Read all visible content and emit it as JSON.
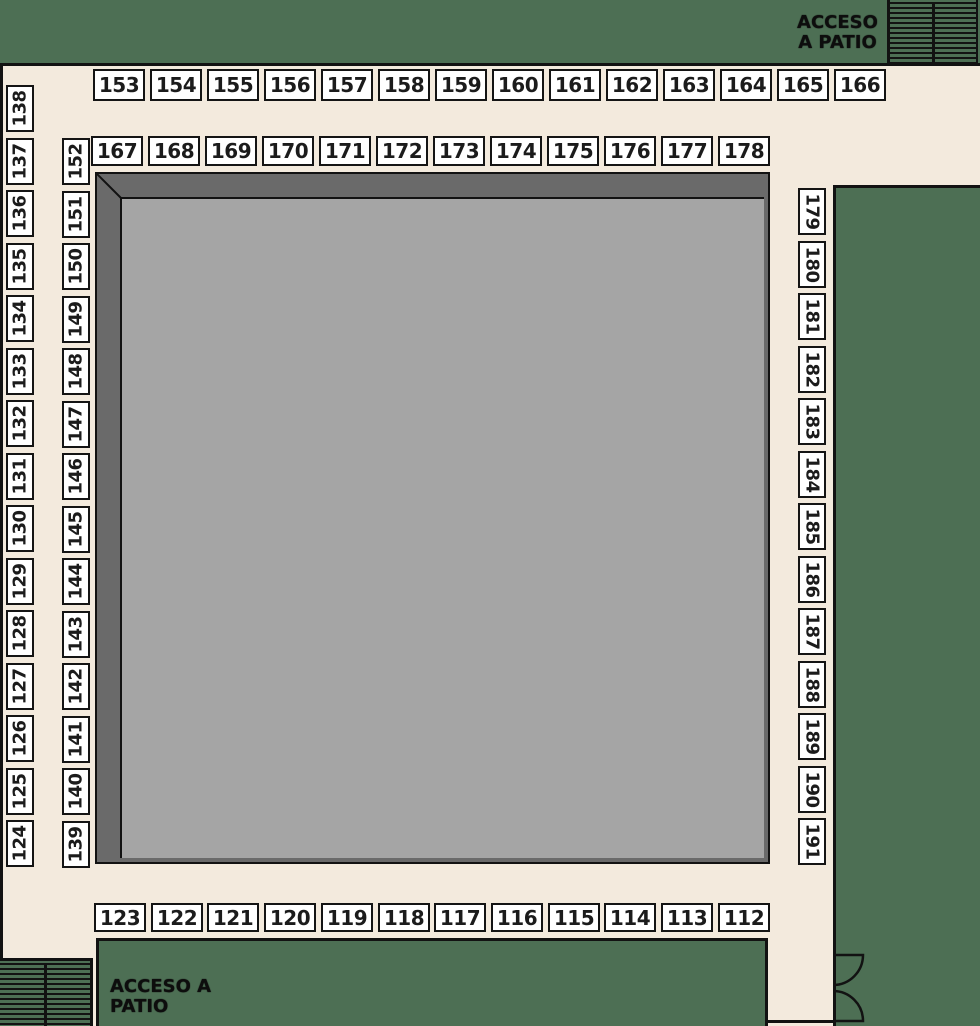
{
  "plan": {
    "access_top_right": {
      "line1": "ACCESO",
      "line2": "A PATIO"
    },
    "access_bottom_left": {
      "line1": "ACCESO A",
      "line2": "PATIO"
    },
    "booth_groups": {
      "top_row": {
        "labels": [
          "153",
          "154",
          "155",
          "156",
          "157",
          "158",
          "159",
          "160",
          "161",
          "162",
          "163",
          "164",
          "165",
          "166"
        ]
      },
      "second_row": {
        "labels": [
          "167",
          "168",
          "169",
          "170",
          "171",
          "172",
          "173",
          "174",
          "175",
          "176",
          "177",
          "178"
        ]
      },
      "left_outer_column": {
        "labels": [
          "138",
          "137",
          "136",
          "135",
          "134",
          "133",
          "132",
          "131",
          "130",
          "129",
          "128",
          "127",
          "126",
          "125",
          "124"
        ]
      },
      "left_inner_column": {
        "labels": [
          "152",
          "151",
          "150",
          "149",
          "148",
          "147",
          "146",
          "145",
          "144",
          "143",
          "142",
          "141",
          "140",
          "139"
        ]
      },
      "right_column": {
        "labels": [
          "179",
          "180",
          "181",
          "182",
          "183",
          "184",
          "185",
          "186",
          "187",
          "188",
          "189",
          "190",
          "191"
        ]
      },
      "bottom_row": {
        "labels": [
          "123",
          "122",
          "121",
          "120",
          "119",
          "118",
          "117",
          "116",
          "115",
          "114",
          "113",
          "112"
        ]
      }
    },
    "colors": {
      "exterior_green": "#4d6f54",
      "walkway_cream": "#f3eadd",
      "booth_fill": "#ffffff",
      "line_black": "#121212",
      "patio_edge_dark": "#6a6a6a",
      "patio_floor_gray": "#a5a5a5"
    }
  }
}
